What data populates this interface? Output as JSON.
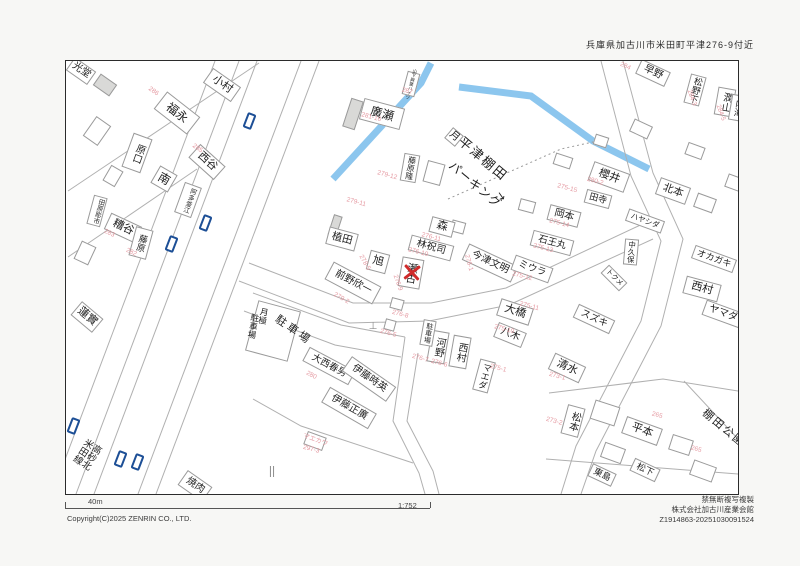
{
  "header": {
    "location": "兵庫県加古川市米田町平津276-9付近"
  },
  "footer": {
    "scale_bar": "40m",
    "ratio": "1:752",
    "copyright": "Copyright(C)2025 ZENRIN CO., LTD.",
    "notice": "禁無断複写複製",
    "issuer": "株式会社加古川産業会館",
    "serial": "Z1914863-20251030091524"
  },
  "colors": {
    "canal": "#8cc6ee",
    "road_line": "#b0b0b0",
    "pink": "#e59aa2",
    "marker_blue": "#1d4f96",
    "target_red": "#cf2b2b"
  },
  "map": {
    "frame": {
      "x": 65,
      "y": 60,
      "w": 672,
      "h": 433
    },
    "target": {
      "x": 411,
      "y": 271,
      "name": "瀬古",
      "address": "276-9"
    },
    "roads": [
      "214,60 51,493",
      "238,60 75,493",
      "256,60 93,493",
      "300,60 137,493",
      "318,60 155,493",
      "67,190 258,62",
      "67,256 196,168",
      "248,262 352,302 430,302 505,287 648,220",
      "238,280 348,322 428,320 508,304 652,238",
      "252,292 340,324 404,336",
      "243,310 334,344 400,356",
      "404,336 392,420 418,472 424,493",
      "417,352 406,420 432,470 438,493",
      "600,60 630,175 660,240 640,320 575,445 560,493",
      "622,60 652,172 682,238 660,325 595,450 580,493",
      "252,398 300,425 412,462",
      "548,392 662,378 737,390",
      "545,458 737,473",
      "683,380 737,438"
    ],
    "canal": [
      "332,178 420,82 430,62",
      "458,86 530,95 592,140 648,168"
    ],
    "boundary_dotted": [
      "447,198 560,148 592,141"
    ],
    "labels": [
      {
        "t": "光堂",
        "x": 80,
        "y": 70,
        "r": 35,
        "s": 10,
        "b": [
          26,
          16
        ]
      },
      {
        "t": "小村",
        "x": 221,
        "y": 84,
        "r": 35,
        "s": 11,
        "b": [
          34,
          18
        ]
      },
      {
        "t": "福永",
        "x": 176,
        "y": 112,
        "r": 38,
        "s": 12,
        "b": [
          42,
          22
        ]
      },
      {
        "t": "西谷",
        "x": 206,
        "y": 161,
        "r": 42,
        "s": 11,
        "b": [
          34,
          18
        ]
      },
      {
        "t": "原口",
        "x": 136,
        "y": 152,
        "r": 20,
        "s": 10,
        "v": 1,
        "b": [
          20,
          36
        ]
      },
      {
        "t": "南",
        "x": 163,
        "y": 178,
        "r": 30,
        "s": 12,
        "b": [
          20,
          20
        ]
      },
      {
        "t": "阿多釜江",
        "x": 187,
        "y": 199,
        "r": 20,
        "s": 6.5,
        "v": 1,
        "b": [
          18,
          32
        ]
      },
      {
        "t": "田原彫市",
        "x": 96,
        "y": 210,
        "r": 15,
        "s": 6.5,
        "v": 1,
        "b": [
          14,
          30
        ]
      },
      {
        "t": "糟谷",
        "x": 122,
        "y": 227,
        "r": 25,
        "s": 11,
        "b": [
          34,
          18
        ]
      },
      {
        "t": "藤原",
        "x": 140,
        "y": 242,
        "r": 15,
        "s": 9,
        "v": 1,
        "b": [
          18,
          30
        ]
      },
      {
        "t": "蓮實",
        "x": 86,
        "y": 316,
        "r": 40,
        "s": 11,
        "b": [
          28,
          18
        ]
      },
      {
        "t": "高砂北米田線",
        "x": 83,
        "y": 456,
        "r": 33,
        "s": 9.5,
        "v": 1
      },
      {
        "t": "廣瀬",
        "x": 381,
        "y": 113,
        "r": 15,
        "s": 12,
        "b": [
          42,
          22
        ]
      },
      {
        "t": "山下興業ハイツ",
        "x": 410,
        "y": 83,
        "r": 15,
        "s": 4.5,
        "v": 1,
        "b": [
          13,
          24
        ]
      },
      {
        "t": "藤原隆",
        "x": 409,
        "y": 167,
        "r": 10,
        "s": 8,
        "v": 1,
        "b": [
          16,
          28
        ]
      },
      {
        "t": "月極",
        "x": 262,
        "y": 315,
        "r": 10,
        "s": 8.5,
        "v": 1
      },
      {
        "t": "駐車場",
        "x": 252,
        "y": 325,
        "r": 10,
        "s": 8.5,
        "v": 1
      },
      {
        "t": "駐車場",
        "x": 292,
        "y": 330,
        "r": 35,
        "s": 11,
        "sp": 3
      },
      {
        "t": "前野欣一",
        "x": 352,
        "y": 282,
        "r": 28,
        "s": 10,
        "b": [
          54,
          20
        ]
      },
      {
        "t": "植田",
        "x": 341,
        "y": 238,
        "r": 15,
        "s": 10.5,
        "b": [
          30,
          18
        ]
      },
      {
        "t": "旭",
        "x": 377,
        "y": 261,
        "r": 15,
        "s": 11,
        "b": [
          20,
          20
        ]
      },
      {
        "t": "森",
        "x": 441,
        "y": 226,
        "r": 15,
        "s": 11,
        "b": [
          24,
          16
        ]
      },
      {
        "t": "林祝司",
        "x": 430,
        "y": 247,
        "r": 15,
        "s": 10,
        "b": [
          44,
          16
        ]
      },
      {
        "t": "瀬古",
        "x": 410,
        "y": 272,
        "r": 10,
        "s": 10.5,
        "v": 1,
        "b": [
          22,
          30
        ]
      },
      {
        "t": "今津文明",
        "x": 489,
        "y": 262,
        "r": 25,
        "s": 10,
        "b": [
          54,
          18
        ]
      },
      {
        "t": "ミウラ",
        "x": 531,
        "y": 268,
        "r": 20,
        "s": 9.5,
        "b": [
          40,
          16
        ]
      },
      {
        "t": "石王丸",
        "x": 551,
        "y": 242,
        "r": 15,
        "s": 9.5,
        "b": [
          42,
          16
        ]
      },
      {
        "t": "岡本",
        "x": 563,
        "y": 215,
        "r": 15,
        "s": 10,
        "b": [
          32,
          16
        ]
      },
      {
        "t": "田寺",
        "x": 597,
        "y": 198,
        "r": 15,
        "s": 9,
        "b": [
          26,
          14
        ]
      },
      {
        "t": "櫻井",
        "x": 608,
        "y": 176,
        "r": 20,
        "s": 11,
        "b": [
          38,
          20
        ]
      },
      {
        "t": "北本",
        "x": 672,
        "y": 190,
        "r": 20,
        "s": 10.5,
        "b": [
          32,
          18
        ]
      },
      {
        "t": "ハヤシダ",
        "x": 644,
        "y": 220,
        "r": 20,
        "s": 7.5,
        "b": [
          38,
          13
        ]
      },
      {
        "t": "中久保",
        "x": 630,
        "y": 251,
        "r": 5,
        "s": 7.5,
        "v": 1,
        "b": [
          14,
          26
        ]
      },
      {
        "t": "トクメ",
        "x": 613,
        "y": 277,
        "r": 45,
        "s": 7,
        "b": [
          26,
          12
        ]
      },
      {
        "t": "早野",
        "x": 652,
        "y": 72,
        "r": 25,
        "s": 10,
        "b": [
          32,
          16
        ]
      },
      {
        "t": "松野下",
        "x": 694,
        "y": 89,
        "r": 15,
        "s": 9,
        "v": 1,
        "b": [
          16,
          30
        ]
      },
      {
        "t": "潤山",
        "x": 724,
        "y": 101,
        "r": 10,
        "s": 10,
        "v": 1,
        "b": [
          18,
          28
        ]
      },
      {
        "t": "内海",
        "x": 737,
        "y": 107,
        "r": 10,
        "s": 9,
        "v": 1,
        "b": [
          16,
          26
        ]
      },
      {
        "t": "オカガキ",
        "x": 713,
        "y": 258,
        "r": 20,
        "s": 9,
        "b": [
          44,
          14
        ]
      },
      {
        "t": "西村",
        "x": 701,
        "y": 288,
        "r": 15,
        "s": 11,
        "b": [
          36,
          18
        ]
      },
      {
        "t": "ヤマダ",
        "x": 722,
        "y": 313,
        "r": 20,
        "s": 10,
        "b": [
          40,
          16
        ]
      },
      {
        "t": "スズキ",
        "x": 593,
        "y": 318,
        "r": 25,
        "s": 9.5,
        "b": [
          40,
          15
        ]
      },
      {
        "t": "清水",
        "x": 566,
        "y": 367,
        "r": 25,
        "s": 11,
        "b": [
          34,
          18
        ]
      },
      {
        "t": "松本",
        "x": 572,
        "y": 420,
        "r": 15,
        "s": 10,
        "v": 1,
        "b": [
          18,
          30
        ]
      },
      {
        "t": "平本",
        "x": 641,
        "y": 430,
        "r": 20,
        "s": 11,
        "b": [
          38,
          18
        ]
      },
      {
        "t": "棚田公園",
        "x": 722,
        "y": 428,
        "r": 40,
        "s": 11,
        "sp": 2
      },
      {
        "t": "大橋",
        "x": 514,
        "y": 311,
        "r": 18,
        "s": 11,
        "b": [
          34,
          18
        ]
      },
      {
        "t": "八木",
        "x": 509,
        "y": 334,
        "r": 22,
        "s": 10,
        "b": [
          30,
          16
        ]
      },
      {
        "t": "河野",
        "x": 437,
        "y": 346,
        "r": 10,
        "s": 10,
        "v": 1,
        "b": [
          18,
          32
        ]
      },
      {
        "t": "西村",
        "x": 459,
        "y": 351,
        "r": 10,
        "s": 10,
        "v": 1,
        "b": [
          18,
          32
        ]
      },
      {
        "t": "マエダ",
        "x": 483,
        "y": 375,
        "r": 15,
        "s": 9,
        "v": 1,
        "b": [
          16,
          32
        ]
      },
      {
        "t": "駐車場",
        "x": 427,
        "y": 332,
        "r": 10,
        "s": 7,
        "v": 1,
        "b": [
          13,
          26
        ]
      },
      {
        "t": "大西春男",
        "x": 328,
        "y": 365,
        "r": 28,
        "s": 9.5,
        "b": [
          52,
          16
        ]
      },
      {
        "t": "伊藤時英",
        "x": 368,
        "y": 378,
        "r": 35,
        "s": 10,
        "b": [
          54,
          18
        ]
      },
      {
        "t": "伊藤正廣",
        "x": 348,
        "y": 407,
        "r": 30,
        "s": 10,
        "b": [
          54,
          18
        ]
      },
      {
        "t": "マエカワ",
        "x": 314,
        "y": 440,
        "r": 20,
        "s": 6.5,
        "b": [
          20,
          14
        ],
        "c": "pink"
      },
      {
        "t": "焼肉",
        "x": 194,
        "y": 485,
        "r": 35,
        "s": 10,
        "b": [
          30,
          18
        ]
      },
      {
        "t": "松下",
        "x": 644,
        "y": 469,
        "r": 25,
        "s": 9,
        "b": [
          28,
          14
        ]
      },
      {
        "t": "東島",
        "x": 601,
        "y": 474,
        "r": 25,
        "s": 9,
        "b": [
          26,
          14
        ]
      },
      {
        "t": "平津棚田",
        "x": 482,
        "y": 158,
        "r": 40,
        "s": 13,
        "sp": 2
      },
      {
        "t": "パーキング",
        "x": 474,
        "y": 184,
        "r": 40,
        "s": 12,
        "sp": 1
      },
      {
        "t": "月",
        "x": 453,
        "y": 136,
        "r": 40,
        "s": 10,
        "b": [
          14,
          14
        ]
      },
      {
        "t": "↘",
        "x": 500,
        "y": 196,
        "r": 10,
        "s": 11
      },
      {
        "t": "⊥",
        "x": 372,
        "y": 326,
        "r": 0,
        "s": 10,
        "c": "gray"
      },
      {
        "t": "||",
        "x": 271,
        "y": 470,
        "r": 0,
        "s": 12,
        "c": "gray"
      }
    ],
    "addresses": [
      {
        "t": "281-16",
        "x": 370,
        "y": 117,
        "r": 15
      },
      {
        "t": "287",
        "x": 406,
        "y": 91,
        "r": 15
      },
      {
        "t": "279-12",
        "x": 386,
        "y": 175,
        "r": 15
      },
      {
        "t": "279-11",
        "x": 355,
        "y": 202,
        "r": 15
      },
      {
        "t": "276-11",
        "x": 430,
        "y": 237,
        "r": 15
      },
      {
        "t": "276-10",
        "x": 417,
        "y": 252,
        "r": 15
      },
      {
        "t": "276-1",
        "x": 467,
        "y": 262,
        "r": 75
      },
      {
        "t": "278-5",
        "x": 363,
        "y": 262,
        "r": 60
      },
      {
        "t": "279-2",
        "x": 340,
        "y": 298,
        "r": 30
      },
      {
        "t": "276-9",
        "x": 396,
        "y": 282,
        "r": 70
      },
      {
        "t": "276-8",
        "x": 399,
        "y": 314,
        "r": 15
      },
      {
        "t": "276-5",
        "x": 387,
        "y": 333,
        "r": 15
      },
      {
        "t": "276-7",
        "x": 419,
        "y": 358,
        "r": 15
      },
      {
        "t": "276-6",
        "x": 438,
        "y": 363,
        "r": 15
      },
      {
        "t": "275-15",
        "x": 566,
        "y": 188,
        "r": 15
      },
      {
        "t": "275-14",
        "x": 558,
        "y": 223,
        "r": 15
      },
      {
        "t": "275-13",
        "x": 542,
        "y": 248,
        "r": 15
      },
      {
        "t": "275-12",
        "x": 521,
        "y": 276,
        "r": 15
      },
      {
        "t": "280-2",
        "x": 594,
        "y": 181,
        "r": 15
      },
      {
        "t": "275-11",
        "x": 528,
        "y": 306,
        "r": 15
      },
      {
        "t": "275-10",
        "x": 503,
        "y": 329,
        "r": 15
      },
      {
        "t": "275-1",
        "x": 497,
        "y": 368,
        "r": 15
      },
      {
        "t": "273-1",
        "x": 556,
        "y": 376,
        "r": 15
      },
      {
        "t": "273-2",
        "x": 553,
        "y": 421,
        "r": 15
      },
      {
        "t": "265",
        "x": 656,
        "y": 415,
        "r": 15
      },
      {
        "t": "265",
        "x": 695,
        "y": 449,
        "r": 15
      },
      {
        "t": "280",
        "x": 310,
        "y": 375,
        "r": 28
      },
      {
        "t": "297-3",
        "x": 310,
        "y": 449,
        "r": 15
      },
      {
        "t": "284-3",
        "x": 690,
        "y": 97,
        "r": 70
      },
      {
        "t": "284-5",
        "x": 719,
        "y": 112,
        "r": 70
      },
      {
        "t": "284",
        "x": 624,
        "y": 66,
        "r": 25
      },
      {
        "t": "286",
        "x": 152,
        "y": 91,
        "r": 35
      },
      {
        "t": "285",
        "x": 196,
        "y": 148,
        "r": 35
      },
      {
        "t": "283",
        "x": 108,
        "y": 233,
        "r": 25
      },
      {
        "t": "282",
        "x": 130,
        "y": 252,
        "r": 25
      }
    ],
    "markers": [
      [
        248,
        120
      ],
      [
        204,
        222
      ],
      [
        170,
        243
      ],
      [
        72,
        425
      ],
      [
        119,
        458
      ],
      [
        136,
        461
      ]
    ],
    "buildings_shaded": [
      [
        352,
        113,
        13,
        30,
        18
      ],
      [
        334,
        225,
        9,
        22,
        18
      ],
      [
        104,
        84,
        20,
        14,
        35
      ]
    ],
    "buildings_extra": [
      [
        96,
        130,
        18,
        24,
        35
      ],
      [
        112,
        175,
        14,
        18,
        30
      ],
      [
        84,
        252,
        16,
        20,
        25
      ],
      [
        433,
        172,
        18,
        22,
        15
      ],
      [
        457,
        226,
        14,
        12,
        15
      ],
      [
        562,
        160,
        18,
        12,
        18
      ],
      [
        640,
        128,
        20,
        14,
        25
      ],
      [
        694,
        150,
        18,
        13,
        20
      ],
      [
        704,
        202,
        20,
        15,
        20
      ],
      [
        734,
        182,
        18,
        14,
        20
      ],
      [
        612,
        452,
        22,
        16,
        20
      ],
      [
        702,
        470,
        24,
        16,
        20
      ],
      [
        396,
        303,
        13,
        11,
        15
      ],
      [
        389,
        324,
        11,
        11,
        15
      ],
      [
        272,
        330,
        44,
        52,
        15
      ],
      [
        604,
        412,
        26,
        20,
        18
      ],
      [
        680,
        444,
        22,
        16,
        18
      ],
      [
        526,
        205,
        16,
        12,
        15
      ],
      [
        600,
        140,
        14,
        11,
        18
      ]
    ]
  }
}
